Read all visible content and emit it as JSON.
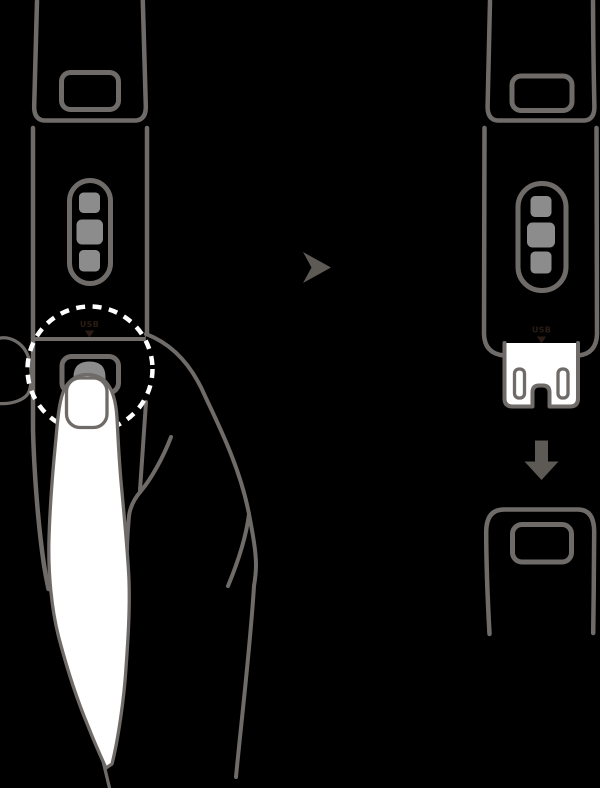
{
  "diagram": {
    "type": "instruction-illustration",
    "subject": "activity-tracker-band-usb-release",
    "panels": [
      {
        "id": "press-release-button",
        "usb_label": "USB"
      },
      {
        "id": "usb-plug-detached",
        "usb_label": "USB"
      }
    ],
    "icons": {
      "next_arrow": "right-dart-arrow",
      "down_arrow": "solid-down-block-arrow",
      "usb_pointer": "small-down-triangle"
    },
    "colors": {
      "background": "#000000",
      "line": "#6f6b68",
      "fill_gray": "#8c8c8c",
      "arrow": "#5d5955",
      "white": "#ffffff",
      "usb_text": "#2a1c14",
      "highlight": "#ffffff"
    }
  }
}
